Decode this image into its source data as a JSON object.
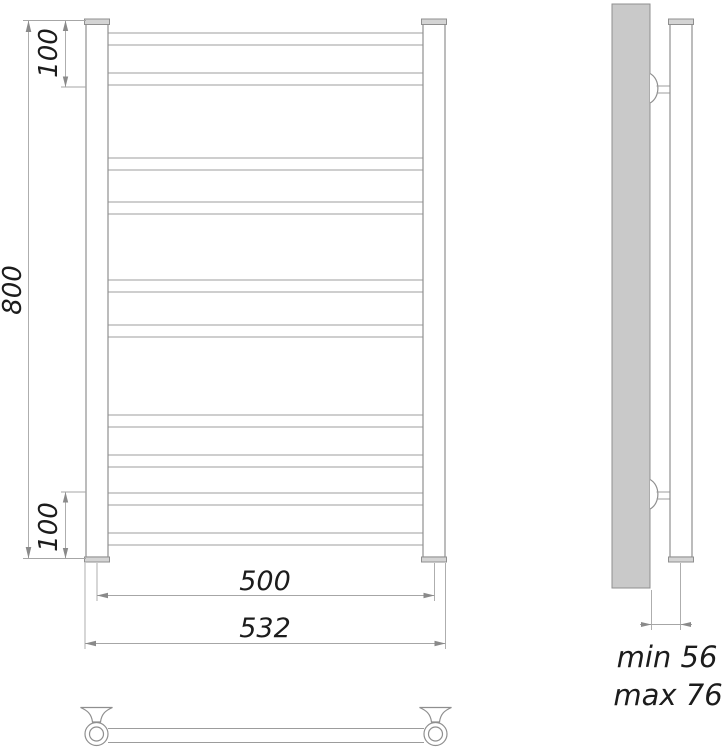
{
  "drawing": {
    "type": "technical-drawing",
    "subject": "ladder towel rail, three views (front, side, top)",
    "rung_count": 10
  },
  "labels": {
    "height": "800",
    "top_offset": "100",
    "bottom_offset": "100",
    "inner_width": "500",
    "overall_width": "532",
    "depth_min": "min 56",
    "depth_max": "max 76"
  },
  "colors": {
    "background": "#ffffff",
    "outline": "#8f8f8f",
    "rung_line": "#9c9c9c",
    "dimension_line": "#a6a6a6",
    "text": "#1c1c1c",
    "wall_fill": "#c9c9c9",
    "cap_fill": "#d4d4d4"
  }
}
